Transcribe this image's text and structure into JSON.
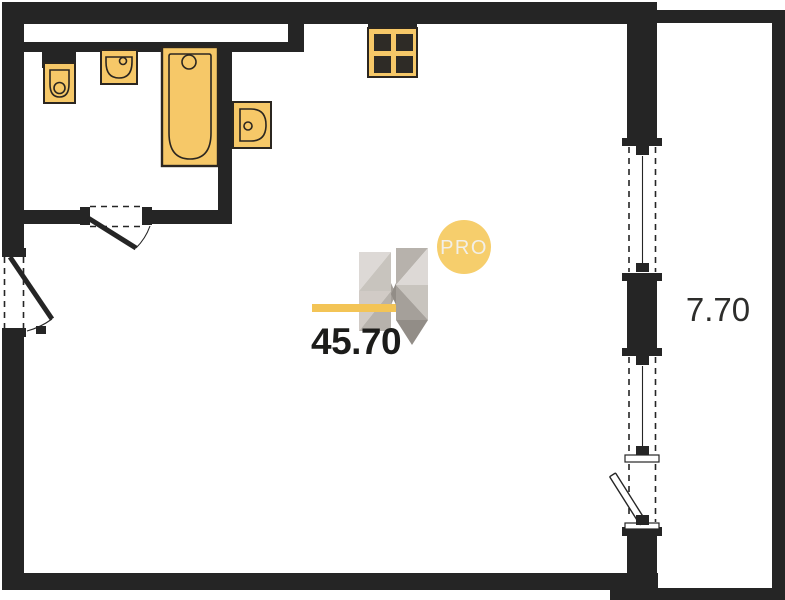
{
  "rooms": {
    "main": {
      "area": "45.70"
    },
    "balcony": {
      "area": "7.70"
    }
  },
  "watermark": {
    "pro_label": "PRO"
  },
  "icons": {
    "toilet-icon": "tank-and-bowl top view",
    "washbasin-icon": "wall sink with faucet dot",
    "bathtub-icon": "rounded tub with drain circle",
    "sink-icon": "d-shaped basin with faucet dot",
    "stove-icon": "2x2 burner grid",
    "door-swing-icon": "leaf line with quarter arc",
    "window-icon": "dashed opening with center mullion",
    "logo-h-icon": "faceted letter H watermark"
  },
  "colors": {
    "wall": "#252525",
    "bg": "#ffffff",
    "fixture-fill": "#F6C868",
    "fixture-stroke": "#2b2620",
    "burner": "#2e2b26",
    "accent-bar": "#F3C14D",
    "badge-fill": "#F6CE6C",
    "badge-text": "#F2EFE8",
    "label-primary": "#1c1c1a",
    "label-secondary": "#2d2d2b",
    "logo-1": "#DCD8D4",
    "logo-2": "#C6C1BB",
    "logo-3": "#B4AEA8",
    "logo-4": "#A19B95",
    "logo-5": "#8D8781",
    "logo-6": "#CFC9C3"
  }
}
